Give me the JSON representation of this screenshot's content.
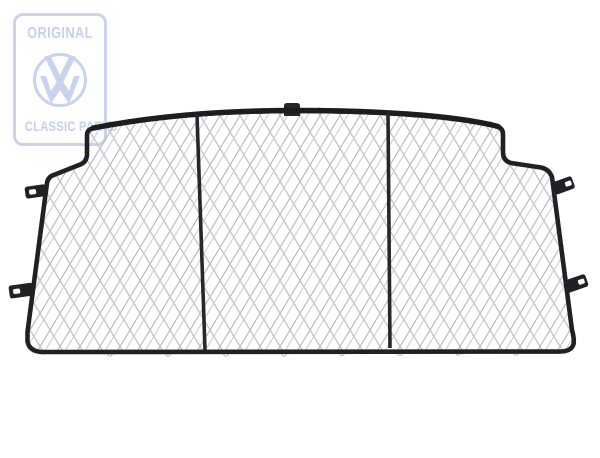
{
  "watermark": {
    "top_label": "ORIGINAL",
    "bottom_label": "CLASSIC PARTS",
    "brand_icon": "vw-roundel",
    "color": "#c6d0ec"
  },
  "photo": {
    "subject": "Black tubular-frame cargo partition net with silver diamond wire mesh, three panels, top clip and four side mounting tabs",
    "frame_color": "#212125",
    "mesh_color": "#b2b3ba",
    "background_color": "#ffffff"
  }
}
